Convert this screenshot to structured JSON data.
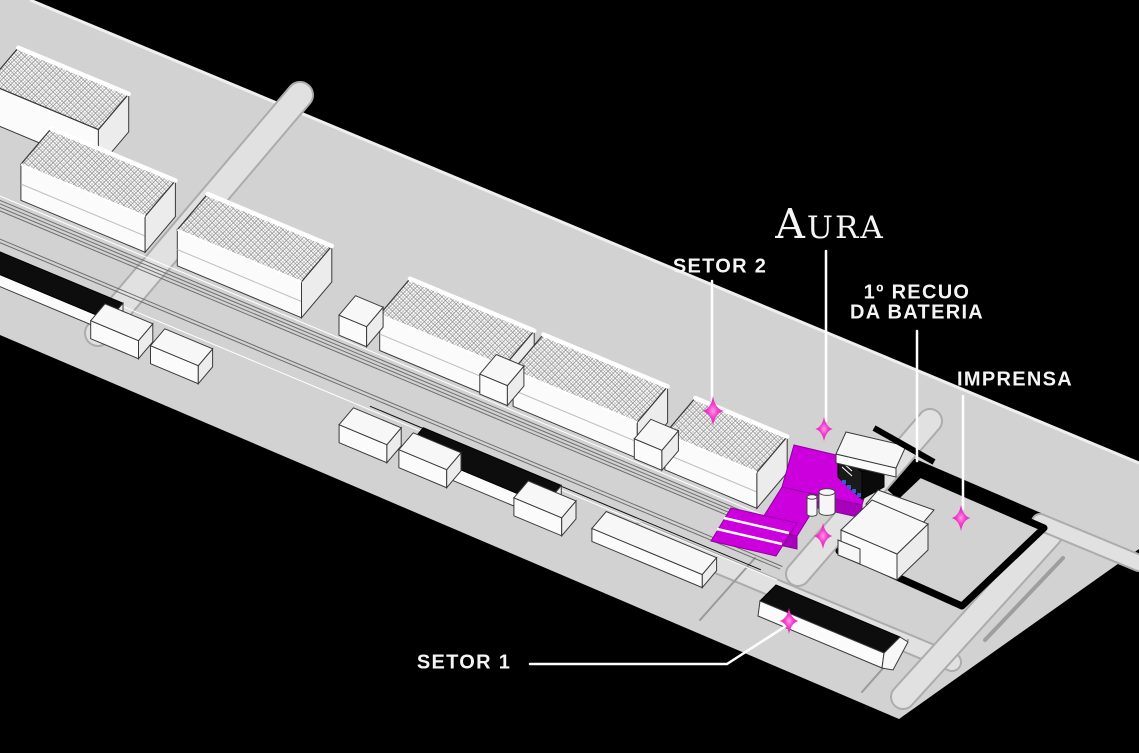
{
  "map": {
    "logo": {
      "text": "AURA",
      "initial": "A",
      "rest": "URA"
    },
    "colors": {
      "bg": "#000000",
      "ground": "#D2D2D2",
      "road": "#E1E1E1",
      "roadEdge": "#ACACAC",
      "outline": "#3A3A3A",
      "building": "#FBFBFB",
      "buildingSide": "#ECECEC",
      "highlight": "#CC00DD",
      "highlightDark": "#A800BB",
      "highlightDarker": "#8E009E",
      "sparkle": "#EC1FBE",
      "sparkleCore": "#FF9BE8",
      "accentBlue": "#2E5FD0",
      "dark": "#0D0D0D",
      "label": "#F5F5F5"
    },
    "annotations": [
      {
        "id": "setor-2",
        "label": "SETOR 2",
        "label_x": 720,
        "label_y": 267,
        "leader": [
          [
            712,
            281
          ],
          [
            712,
            401
          ]
        ],
        "sparkle": {
          "x": 713,
          "y": 411,
          "r": 15
        }
      },
      {
        "id": "aura",
        "label": "AURA",
        "is_logo": true,
        "label_x": 830,
        "label_y": 224,
        "leader": [
          [
            826,
            251
          ],
          [
            826,
            421
          ]
        ],
        "sparkle": {
          "x": 824,
          "y": 429,
          "r": 12
        }
      },
      {
        "id": "recuo-bateria",
        "label": "1º RECUO DA BATERIA",
        "lines": [
          "1º RECUO",
          "DA BATERIA"
        ],
        "label_x": 917,
        "label_y": 303,
        "leader": [
          [
            917,
            331
          ],
          [
            917,
            461
          ]
        ],
        "sparkle": {
          "x": 823,
          "y": 536,
          "r": 13
        }
      },
      {
        "id": "imprensa",
        "label": "IMPRENSA",
        "label_x": 1015,
        "label_y": 380,
        "leader": [
          [
            963,
            396
          ],
          [
            963,
            509
          ]
        ],
        "sparkle": {
          "x": 961,
          "y": 518,
          "r": 13
        }
      },
      {
        "id": "setor-1",
        "label": "SETOR 1",
        "label_x": 464,
        "label_y": 663,
        "leader": [
          [
            530,
            664
          ],
          [
            727,
            664
          ],
          [
            789,
            624
          ]
        ],
        "sparkle": {
          "x": 789,
          "y": 621,
          "r": 13
        }
      }
    ]
  }
}
